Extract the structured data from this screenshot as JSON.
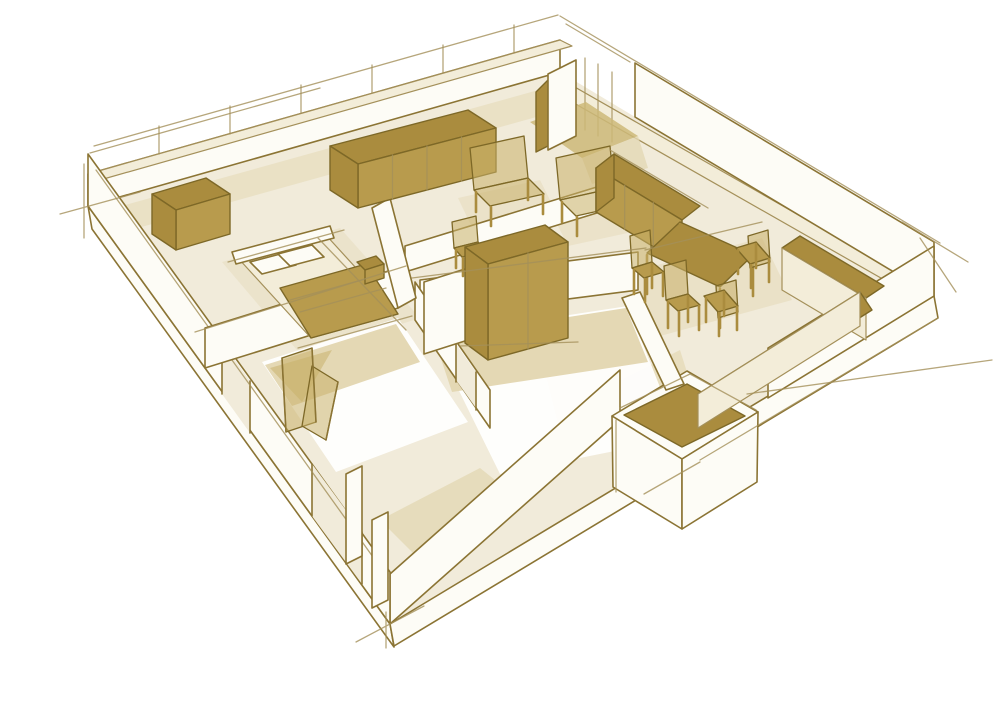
{
  "title": "Hand-drawn sepia 3D cutaway floor plan sketch of an apartment",
  "colors": {
    "bg": "#ffffff",
    "line": "#8b7434",
    "lineSoft": "#a4905a",
    "lineDark": "#7d6827",
    "floor": "#f1ebda",
    "wall": "#fdfcf6",
    "wallTint": "#f3edd9",
    "wedge": "#e4d8b4",
    "wedgeDark": "#cdb878",
    "furn": "#aa8c3e",
    "furnLight": "#b89b4d",
    "furnTrans": "#c9b06a",
    "white": "#ffffff"
  },
  "scene": {
    "type": "architectural-sketch",
    "view": "3d-cutaway-floor-plan",
    "rooms": [
      "living-room",
      "bedroom",
      "kitchen-dining",
      "bathroom",
      "storage-room",
      "entry"
    ],
    "furniture": [
      "sideboard",
      "dresser",
      "double-bed",
      "bedside-table",
      "armchair-left",
      "armchair-right",
      "desk-chair",
      "wardrobe",
      "kitchen-counter",
      "dining-table",
      "dining-chairs",
      "l-shaped-counter",
      "entry-closet",
      "folding-screen"
    ]
  }
}
